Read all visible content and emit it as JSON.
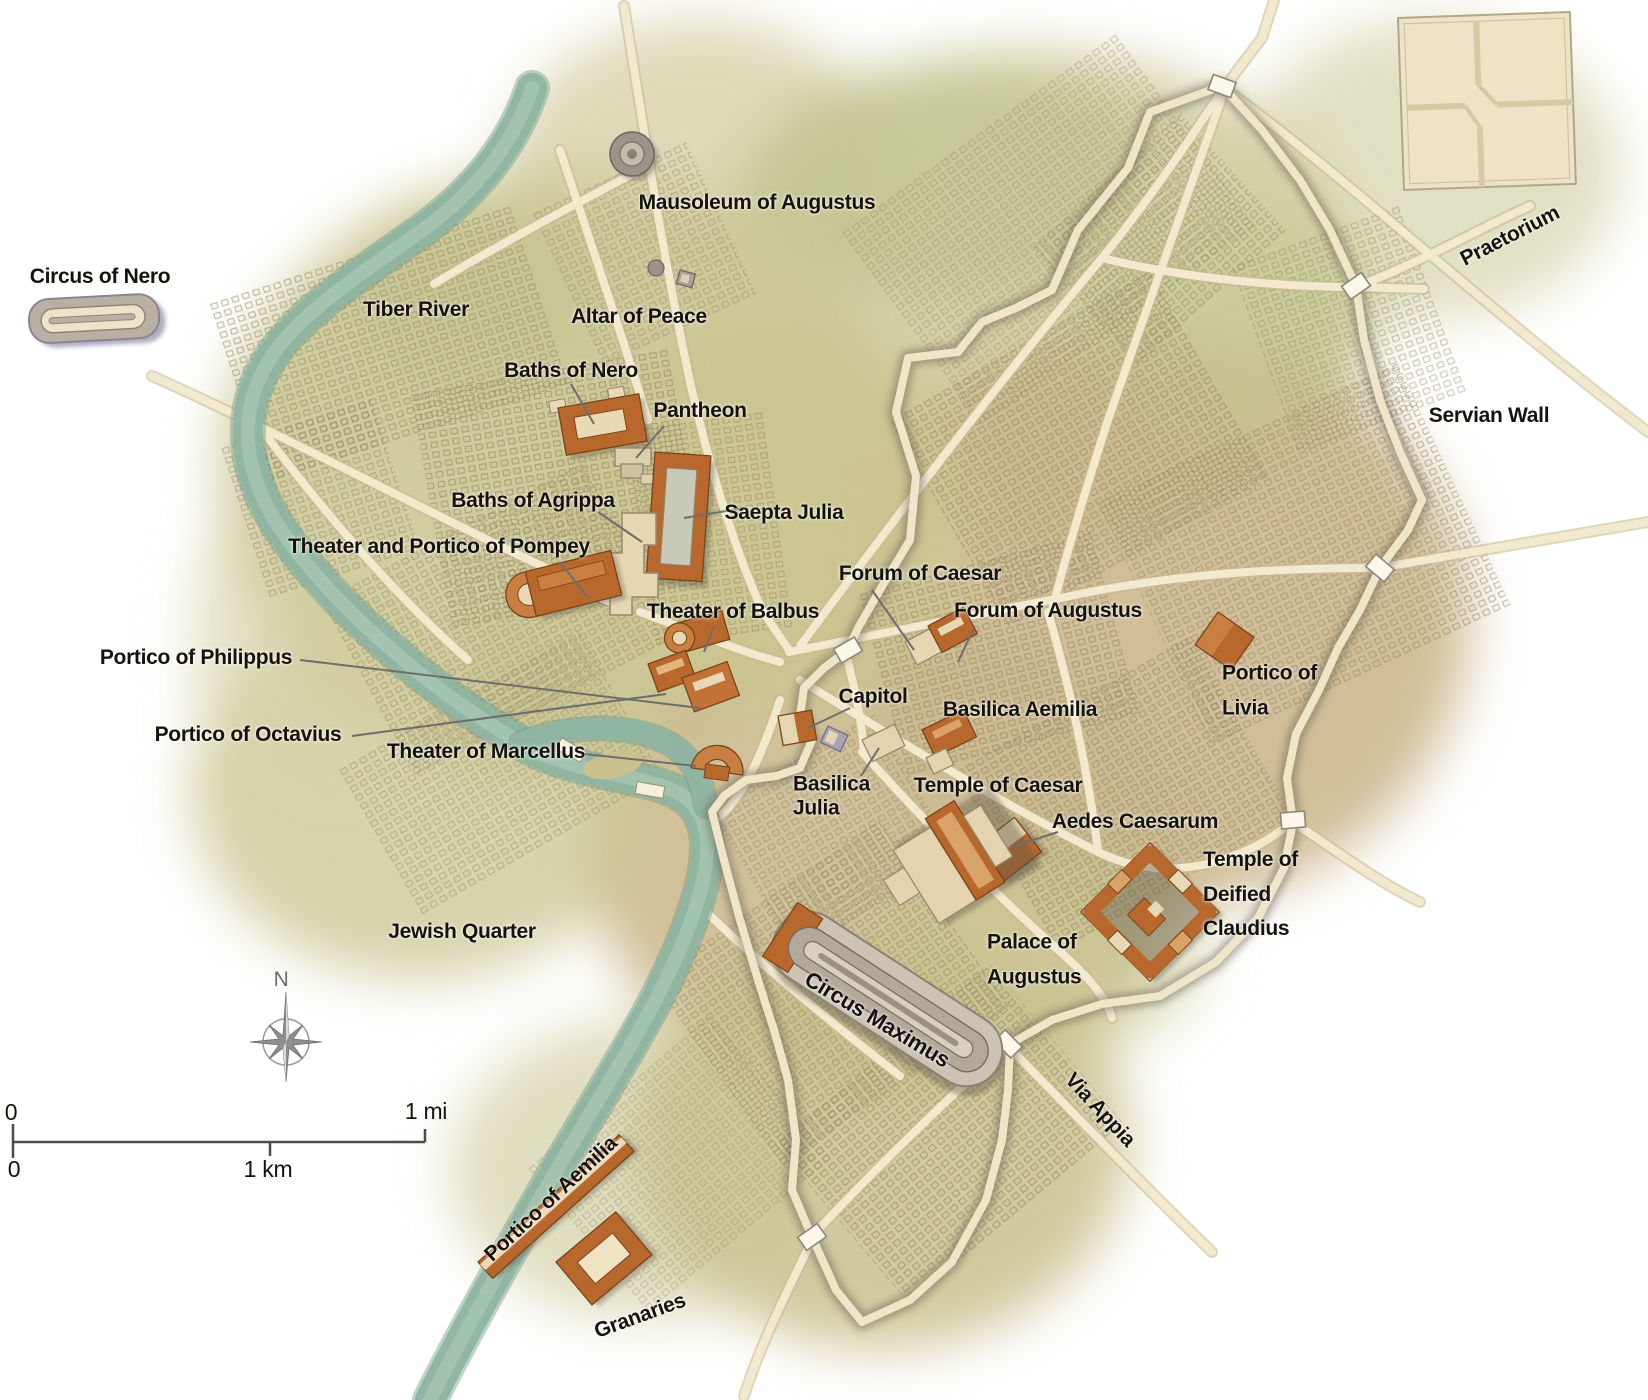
{
  "map": {
    "subject": "Map of ancient Rome with monuments, Tiber River and Servian Wall"
  },
  "palette": {
    "building_orange": "#b8682c",
    "building_orange_light": "#c97f42",
    "building_cream": "#e6d6b2",
    "structure_gray": "#b9b0a3",
    "river": "#8fb5a2",
    "road": "#f2e9cf",
    "terrain_olive": "#c7c28c",
    "terrain_tan": "#ccb78e",
    "wall_shadow": "#6b6254",
    "label_text": "#16130e",
    "compass_gray": "#8e8e8e"
  },
  "labels": [
    {
      "id": "circus-of-nero",
      "text": "Circus of Nero",
      "x": 100,
      "y": 277,
      "rot": 0,
      "size": 21,
      "anchor": "c"
    },
    {
      "id": "tiber-river",
      "text": "Tiber River",
      "x": 416,
      "y": 310,
      "rot": 0,
      "size": 21,
      "anchor": "c"
    },
    {
      "id": "mausoleum-of-augustus",
      "text": "Mausoleum of Augustus",
      "x": 757,
      "y": 203,
      "rot": 0,
      "size": 21,
      "anchor": "c"
    },
    {
      "id": "altar-of-peace",
      "text": "Altar of Peace",
      "x": 639,
      "y": 317,
      "rot": 0,
      "size": 21,
      "anchor": "c"
    },
    {
      "id": "baths-of-nero",
      "text": "Baths of Nero",
      "x": 571,
      "y": 371,
      "rot": 0,
      "size": 21,
      "anchor": "c"
    },
    {
      "id": "pantheon",
      "text": "Pantheon",
      "x": 700,
      "y": 411,
      "rot": 0,
      "size": 21,
      "anchor": "c"
    },
    {
      "id": "baths-of-agrippa",
      "text": "Baths of Agrippa",
      "x": 533,
      "y": 501,
      "rot": 0,
      "size": 21,
      "anchor": "c"
    },
    {
      "id": "saepta-julia",
      "text": "Saepta Julia",
      "x": 784,
      "y": 513,
      "rot": 0,
      "size": 21,
      "anchor": "c"
    },
    {
      "id": "theater-portico-pompey",
      "text": "Theater and Portico of Pompey",
      "x": 439,
      "y": 547,
      "rot": 0,
      "size": 21,
      "anchor": "c"
    },
    {
      "id": "theater-of-balbus",
      "text": "Theater of Balbus",
      "x": 733,
      "y": 612,
      "rot": 0,
      "size": 21,
      "anchor": "c"
    },
    {
      "id": "portico-of-philippus",
      "text": "Portico of Philippus",
      "x": 196,
      "y": 658,
      "rot": 0,
      "size": 21,
      "anchor": "c"
    },
    {
      "id": "portico-of-octavius",
      "text": "Portico of Octavius",
      "x": 248,
      "y": 735,
      "rot": 0,
      "size": 21,
      "anchor": "c"
    },
    {
      "id": "theater-of-marcellus",
      "text": "Theater of Marcellus",
      "x": 486,
      "y": 752,
      "rot": 0,
      "size": 21,
      "anchor": "c"
    },
    {
      "id": "forum-of-caesar",
      "text": "Forum of Caesar",
      "x": 920,
      "y": 574,
      "rot": 0,
      "size": 21,
      "anchor": "c"
    },
    {
      "id": "forum-of-augustus",
      "text": "Forum of Augustus",
      "x": 1048,
      "y": 611,
      "rot": 0,
      "size": 21,
      "anchor": "c"
    },
    {
      "id": "capitol",
      "text": "Capitol",
      "x": 873,
      "y": 697,
      "rot": 0,
      "size": 21,
      "anchor": "c"
    },
    {
      "id": "basilica-aemilia",
      "text": "Basilica Aemilia",
      "x": 1020,
      "y": 710,
      "rot": 0,
      "size": 21,
      "anchor": "c"
    },
    {
      "id": "portico-of-livia",
      "text": "Portico of\nLivia",
      "x": 1222,
      "y": 691,
      "rot": 0,
      "size": 21,
      "anchor": "l",
      "lh": 1.65
    },
    {
      "id": "basilica-julia",
      "text": "Basilica\nJulia",
      "x": 793,
      "y": 796,
      "rot": 0,
      "size": 21,
      "anchor": "l",
      "lh": 1.12
    },
    {
      "id": "temple-of-caesar",
      "text": "Temple of Caesar",
      "x": 998,
      "y": 786,
      "rot": 0,
      "size": 21,
      "anchor": "c"
    },
    {
      "id": "aedes-caesarum",
      "text": "Aedes Caesarum",
      "x": 1135,
      "y": 822,
      "rot": 0,
      "size": 21,
      "anchor": "c"
    },
    {
      "id": "temple-of-deified-claudius",
      "text": "Temple of\nDeified\nClaudius",
      "x": 1203,
      "y": 895,
      "rot": 0,
      "size": 21,
      "anchor": "l",
      "lh": 1.65
    },
    {
      "id": "palace-of-augustus",
      "text": "Palace of\nAugustus",
      "x": 987,
      "y": 960,
      "rot": 0,
      "size": 21,
      "anchor": "l",
      "lh": 1.65
    },
    {
      "id": "jewish-quarter",
      "text": "Jewish Quarter",
      "x": 462,
      "y": 932,
      "rot": 0,
      "size": 21,
      "anchor": "c"
    },
    {
      "id": "circus-maximus",
      "text": "Circus Maximus",
      "x": 877,
      "y": 1020,
      "rot": 31,
      "size": 22,
      "anchor": "c"
    },
    {
      "id": "via-appia",
      "text": "Via Appia",
      "x": 1100,
      "y": 1110,
      "rot": 47,
      "size": 21,
      "anchor": "c"
    },
    {
      "id": "servian-wall",
      "text": "Servian Wall",
      "x": 1489,
      "y": 416,
      "rot": 0,
      "size": 21,
      "anchor": "c"
    },
    {
      "id": "praetorium",
      "text": "Praetorium",
      "x": 1510,
      "y": 236,
      "rot": -27,
      "size": 21,
      "anchor": "c"
    },
    {
      "id": "portico-of-aemilia",
      "text": "Portico of Aemilia",
      "x": 551,
      "y": 1199,
      "rot": -43,
      "size": 21,
      "anchor": "c"
    },
    {
      "id": "granaries",
      "text": "Granaries",
      "x": 640,
      "y": 1316,
      "rot": -20,
      "size": 21,
      "anchor": "c"
    },
    {
      "id": "scale-zero-mi",
      "text": "0",
      "x": 11,
      "y": 1113,
      "rot": 0,
      "size": 23,
      "anchor": "c",
      "weight": 400
    },
    {
      "id": "scale-one-mi",
      "text": "1 mi",
      "x": 426,
      "y": 1112,
      "rot": 0,
      "size": 23,
      "anchor": "c",
      "weight": 400
    },
    {
      "id": "scale-zero-km",
      "text": "0",
      "x": 14,
      "y": 1170,
      "rot": 0,
      "size": 23,
      "anchor": "c",
      "weight": 400
    },
    {
      "id": "scale-one-km",
      "text": "1 km",
      "x": 268,
      "y": 1170,
      "rot": 0,
      "size": 23,
      "anchor": "c",
      "weight": 400
    },
    {
      "id": "compass-north",
      "text": "N",
      "x": 281,
      "y": 980,
      "rot": 0,
      "size": 21,
      "anchor": "c",
      "weight": 400,
      "color": "#6a6a6a"
    }
  ]
}
